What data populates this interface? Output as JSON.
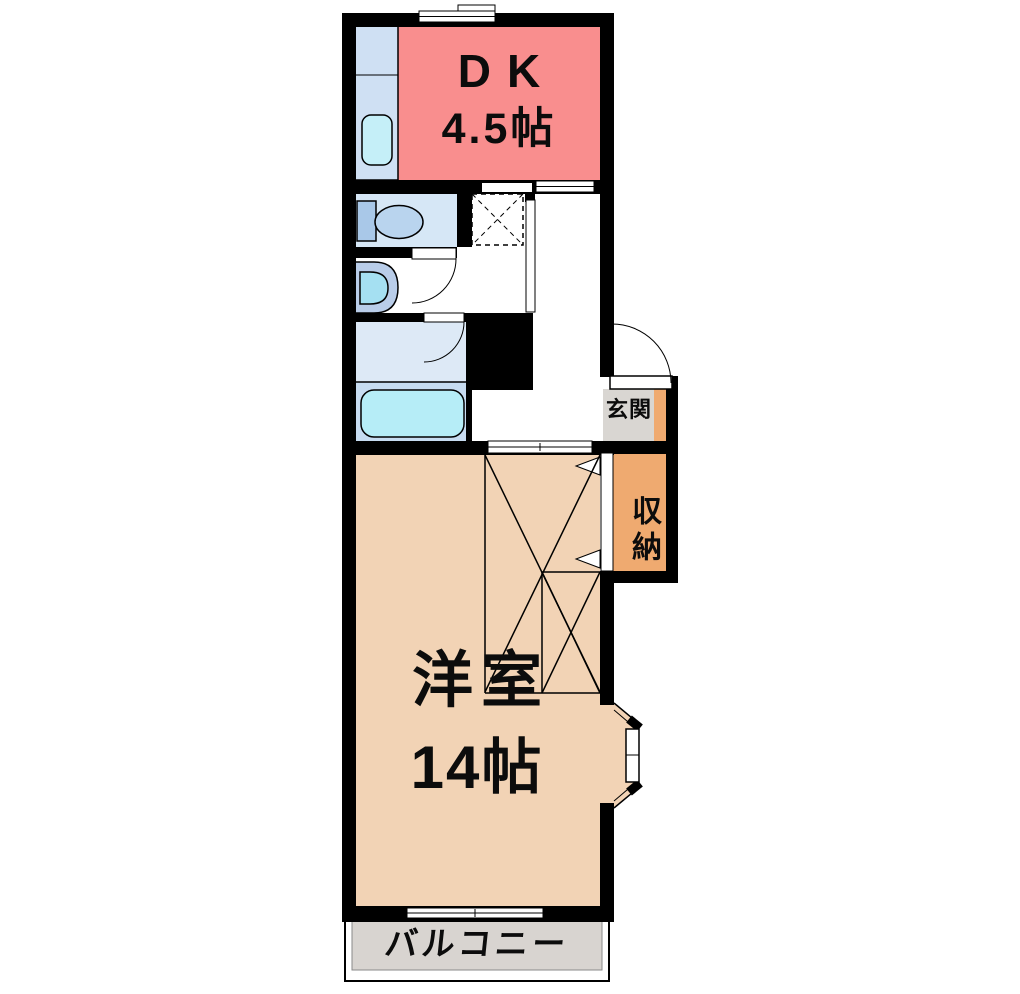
{
  "plan_title": "1DK apartment floor plan",
  "rooms": {
    "dk": {
      "name": "DK",
      "size": "4.5帖"
    },
    "western_room": {
      "name": "洋室",
      "size": "14帖"
    },
    "entrance": {
      "name": "玄関"
    },
    "storage": {
      "name": "収納"
    },
    "balcony": {
      "name": "バルコニー"
    }
  },
  "fixtures": [
    "kitchen-counter",
    "kitchen-sink",
    "refrigerator-space",
    "toilet",
    "washbasin",
    "bathtub",
    "closet",
    "sliding-doors",
    "entrance-door",
    "bay-window",
    "windows"
  ],
  "colors": {
    "wall": "#000000",
    "dk": "#f98e8e",
    "western_room": "#f2d3b5",
    "storage": "#efaa70",
    "entrance_accent": "#efaa70",
    "entrance_floor": "#d9d6d2",
    "balcony_floor": "#d8d4d0",
    "toilet_room": "#d6e7f6",
    "bath_upper": "#dde9f6",
    "bath_lower": "#c7dcf1",
    "bathtub": "#b6edf7",
    "kitchen_counter": "#cfe0f3",
    "kitchen_sink": "#c5eff8",
    "toilet_tank": "#a9c8e8",
    "toilet_bowl": "#b9d4ee",
    "washbasin_outer": "#b9cde9",
    "washbasin_inner": "#a5e0f2"
  }
}
